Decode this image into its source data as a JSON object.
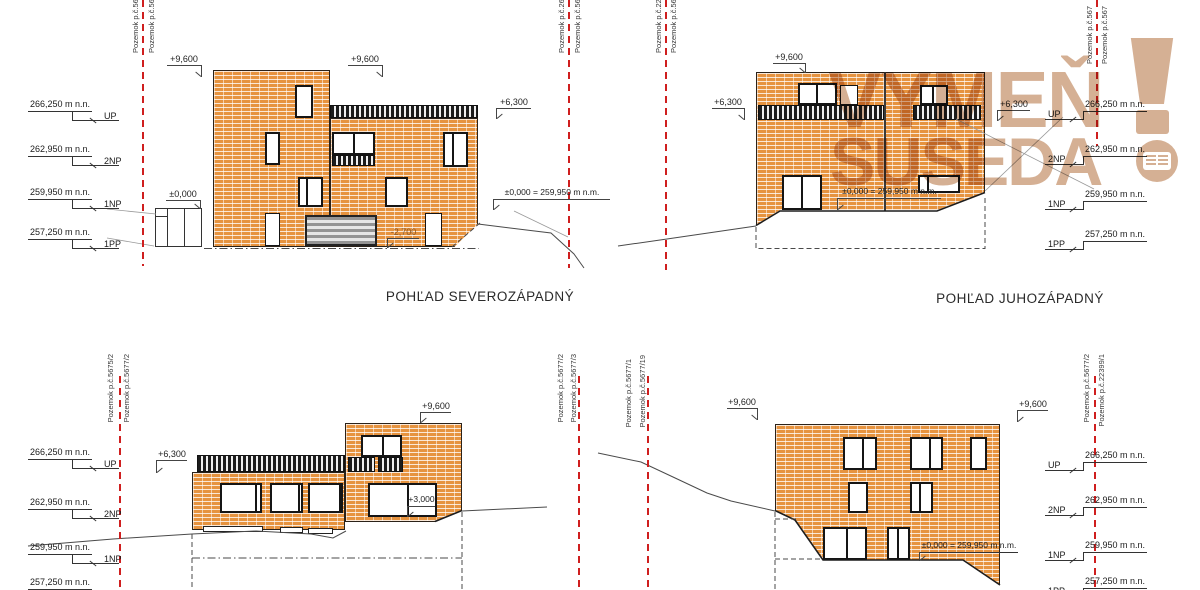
{
  "watermark": {
    "line1": "VYMEŇ",
    "line2": "SUSEDA",
    "color": "#d5b094"
  },
  "colors": {
    "brick": "#e6933f",
    "parcel_line_red": "#cf1f1f",
    "ink": "#2a2a2a"
  },
  "panels": {
    "tl": {
      "title": "POHĽAD SEVEROZÁPADNÝ",
      "levels": [
        {
          "value": "266,250 m n.n.",
          "label": "UP"
        },
        {
          "value": "262,950 m n.n.",
          "label": "2NP"
        },
        {
          "value": "259,950 m n.n.",
          "label": "1NP"
        },
        {
          "value": "257,250 m n.n.",
          "label": "1PP"
        }
      ],
      "dims": {
        "d9600a": "+9,600",
        "d9600b": "+9,600",
        "d6300": "+6,300",
        "zero": "±0,000",
        "zero_eq": "±0,000 = 259,950 m n.m.",
        "minus2700": "-2,700"
      },
      "parcels_left": [
        "Pozemok p.č.567",
        "Pozemok p.č.567"
      ],
      "parcels_right": [
        "Pozemok p.č.267",
        "Pozemok p.č.567"
      ]
    },
    "tr": {
      "title": "POHĽAD JUHOZÁPADNÝ",
      "levels": [
        {
          "value": "266,250 m n.n.",
          "label": "UP"
        },
        {
          "value": "262,950 m n.n.",
          "label": "2NP"
        },
        {
          "value": "259,950 m n.n.",
          "label": "1NP"
        },
        {
          "value": "257,250 m n.n.",
          "label": "1PP"
        }
      ],
      "dims": {
        "d9600": "+9,600",
        "d6300l": "+6,300",
        "d6300r": "+6,300",
        "zero_eq": "±0,000 = 259,950 m n.m."
      },
      "parcels_left": [
        "Pozemok p.č.223",
        "Pozemok p.č.567"
      ],
      "parcels_right": [
        "Pozemok p.č.567",
        "Pozemok p.č.567"
      ]
    },
    "bl": {
      "levels": [
        {
          "value": "266,250 m n.n.",
          "label": "UP"
        },
        {
          "value": "262,950 m n.n.",
          "label": "2NP"
        },
        {
          "value": "259,950 m n.n.",
          "label": "1NP"
        },
        {
          "value": "257,250 m n.n.",
          "label": "1PP"
        }
      ],
      "dims": {
        "d9600": "+9,600",
        "d6300": "+6,300",
        "d3000": "+3,000"
      },
      "parcels_left": [
        "Pozemok p.č.5675/2",
        "Pozemok p.č.5677/2"
      ],
      "parcels_right": [
        "Pozemok p.č.5677/2",
        "Pozemok p.č.5677/3"
      ]
    },
    "br": {
      "levels": [
        {
          "value": "266,250 m n.n.",
          "label": "UP"
        },
        {
          "value": "262,950 m n.n.",
          "label": "2NP"
        },
        {
          "value": "259,950 m n.n.",
          "label": "1NP"
        },
        {
          "value": "257,250 m n.n.",
          "label": "1PP"
        }
      ],
      "dims": {
        "d9600l": "+9,600",
        "d9600r": "+9,600",
        "zero_eq": "±0,000 = 259,950 m n.m."
      },
      "parcels_left": [
        "Pozemok p.č.5677/1",
        "Pozemok p.č.5677/19"
      ],
      "parcels_right": [
        "Pozemok p.č.5677/2",
        "Pozemok p.č.22399/1"
      ]
    }
  }
}
